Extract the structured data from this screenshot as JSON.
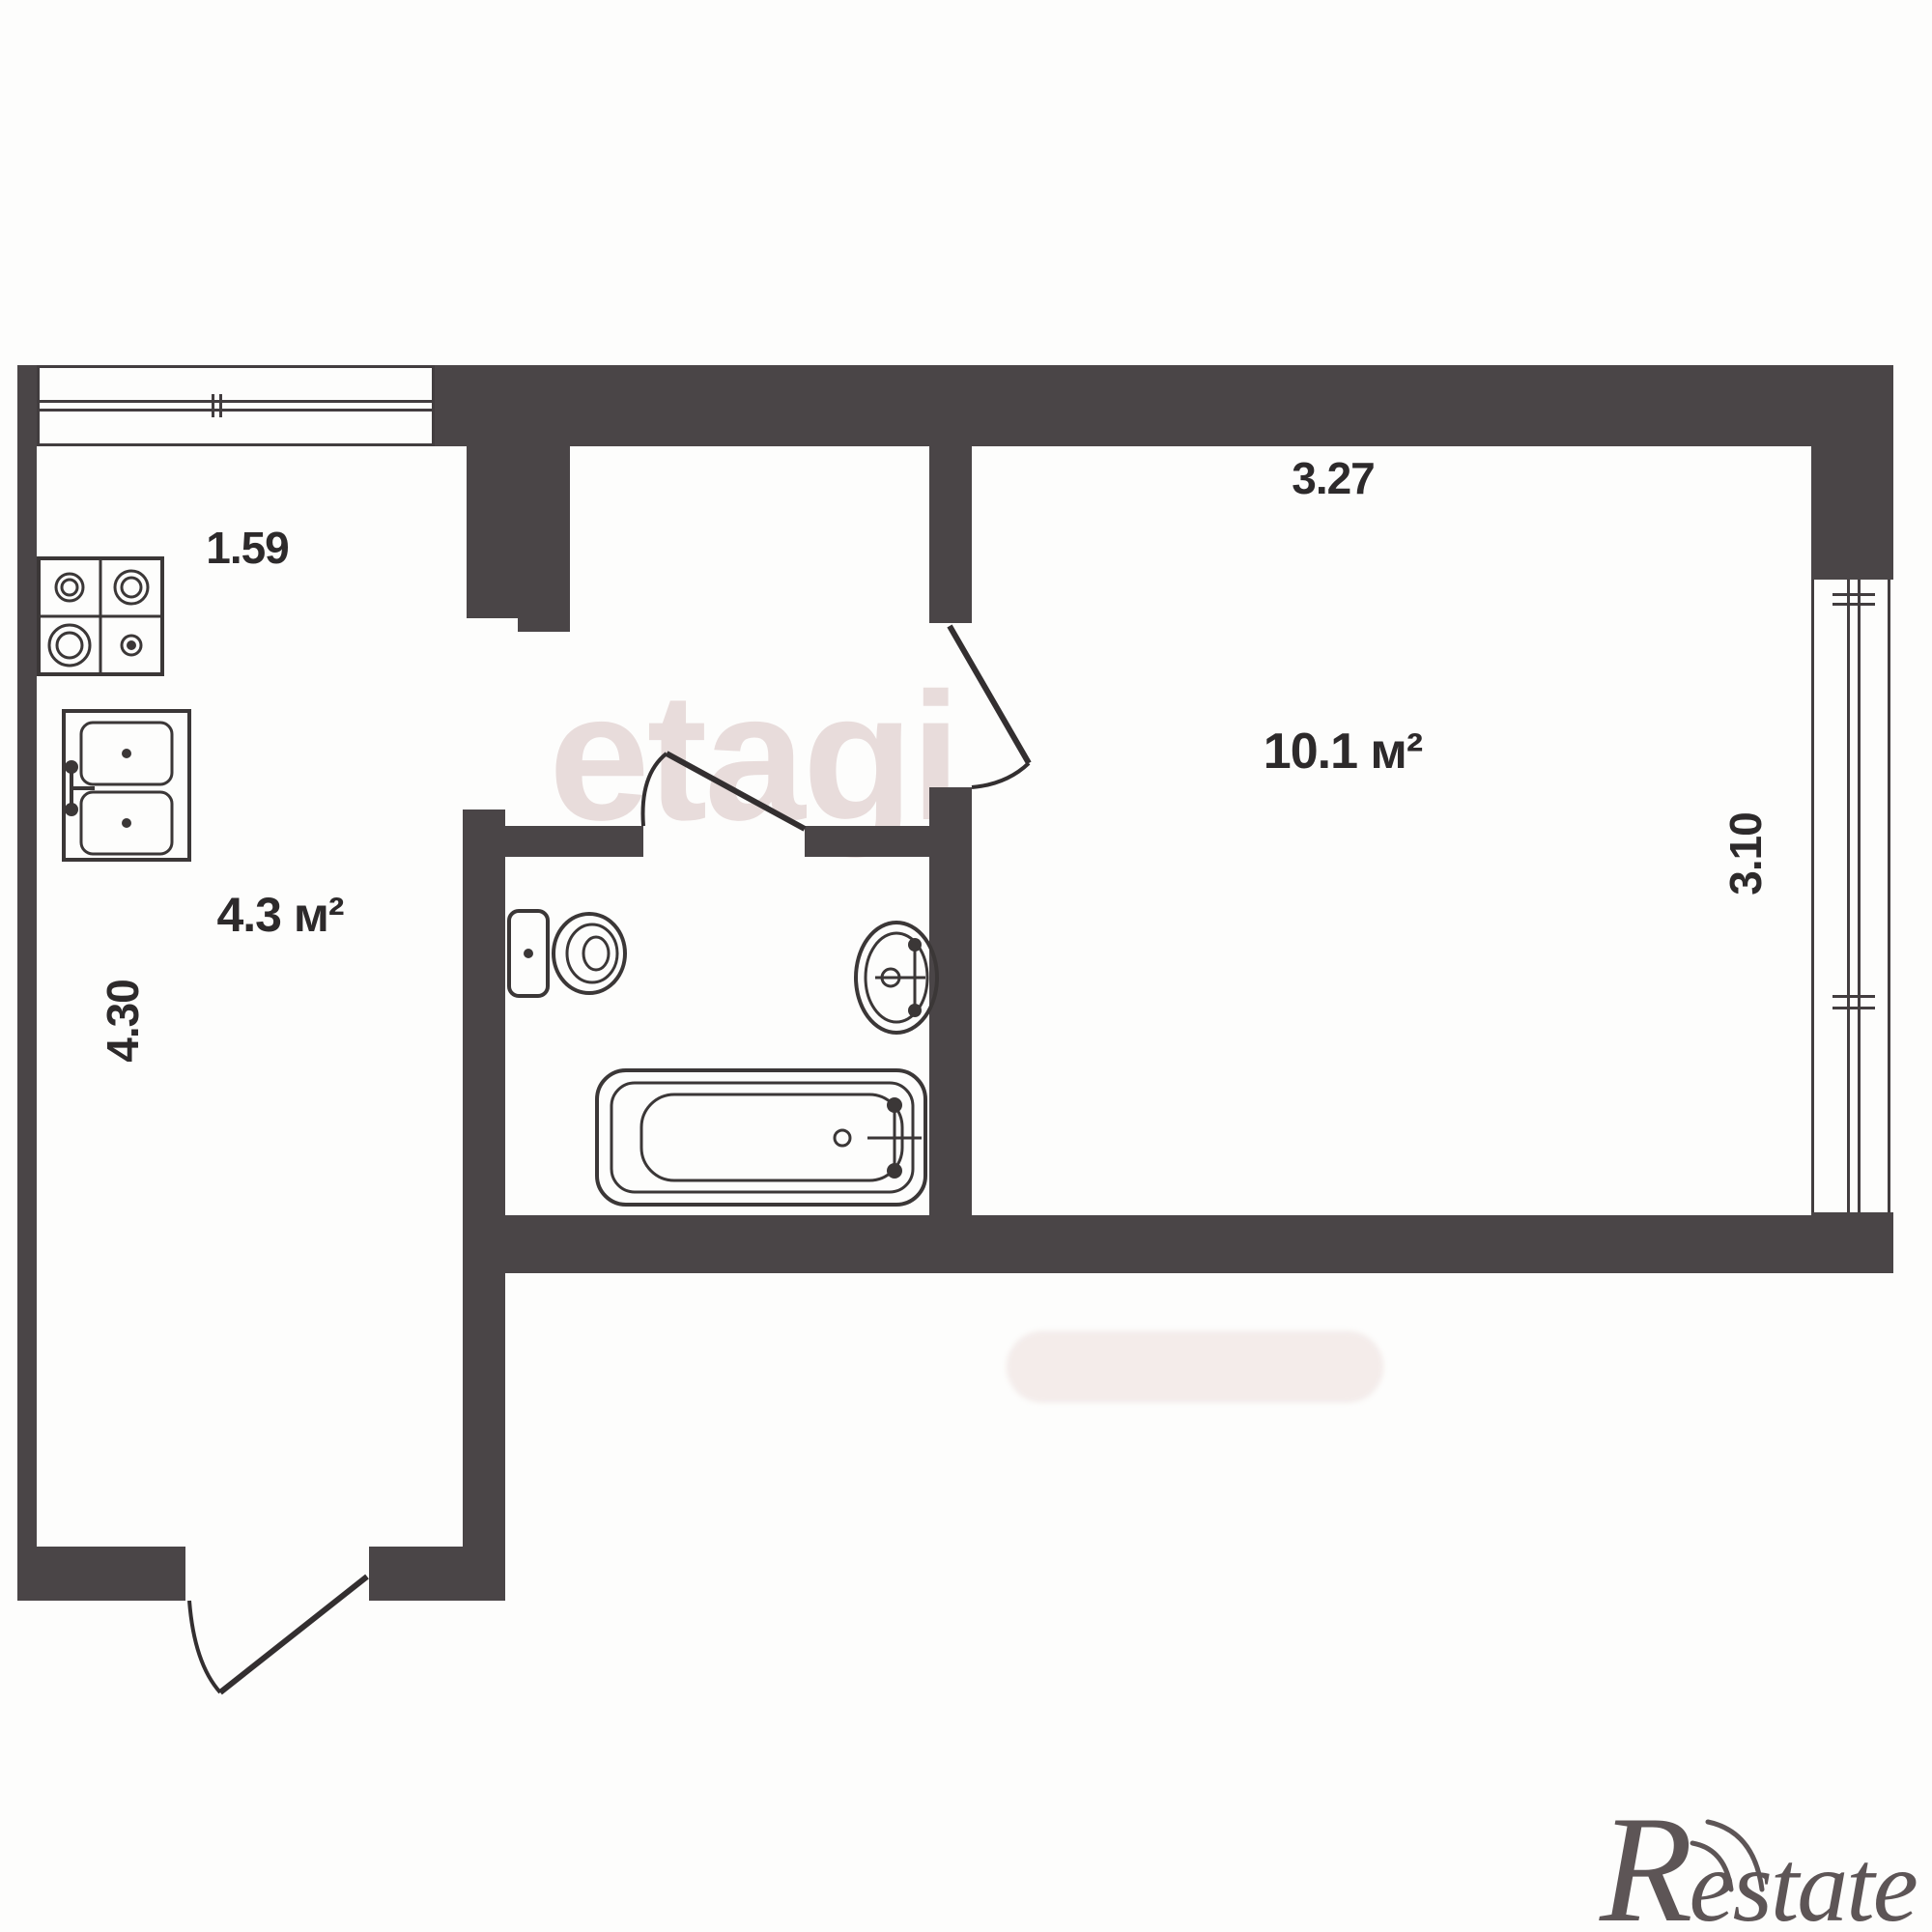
{
  "rooms": {
    "kitchen": {
      "area": "4.3 м²",
      "width_dim": "1.59",
      "depth_dim": "4.30"
    },
    "living": {
      "area": "10.1 м²",
      "width_dim": "3.27",
      "depth_dim": "3.10"
    }
  },
  "watermarks": {
    "brand": "etagi",
    "agency_initial": "R",
    "agency_rest": "estate"
  },
  "fixtures": [
    "stove-icon",
    "kitchen-sink-icon",
    "toilet-icon",
    "washbasin-icon",
    "bathtub-icon",
    "entrance-door-swing",
    "bathroom-door-swing",
    "living-room-door-swing",
    "kitchen-window",
    "living-room-window"
  ],
  "colors": {
    "wall": "#4a4547",
    "fixture_line": "#3b3737",
    "label_text": "#2d2a2b",
    "watermark_tint": "#dbc8c6",
    "background": "#fdfdfc"
  }
}
